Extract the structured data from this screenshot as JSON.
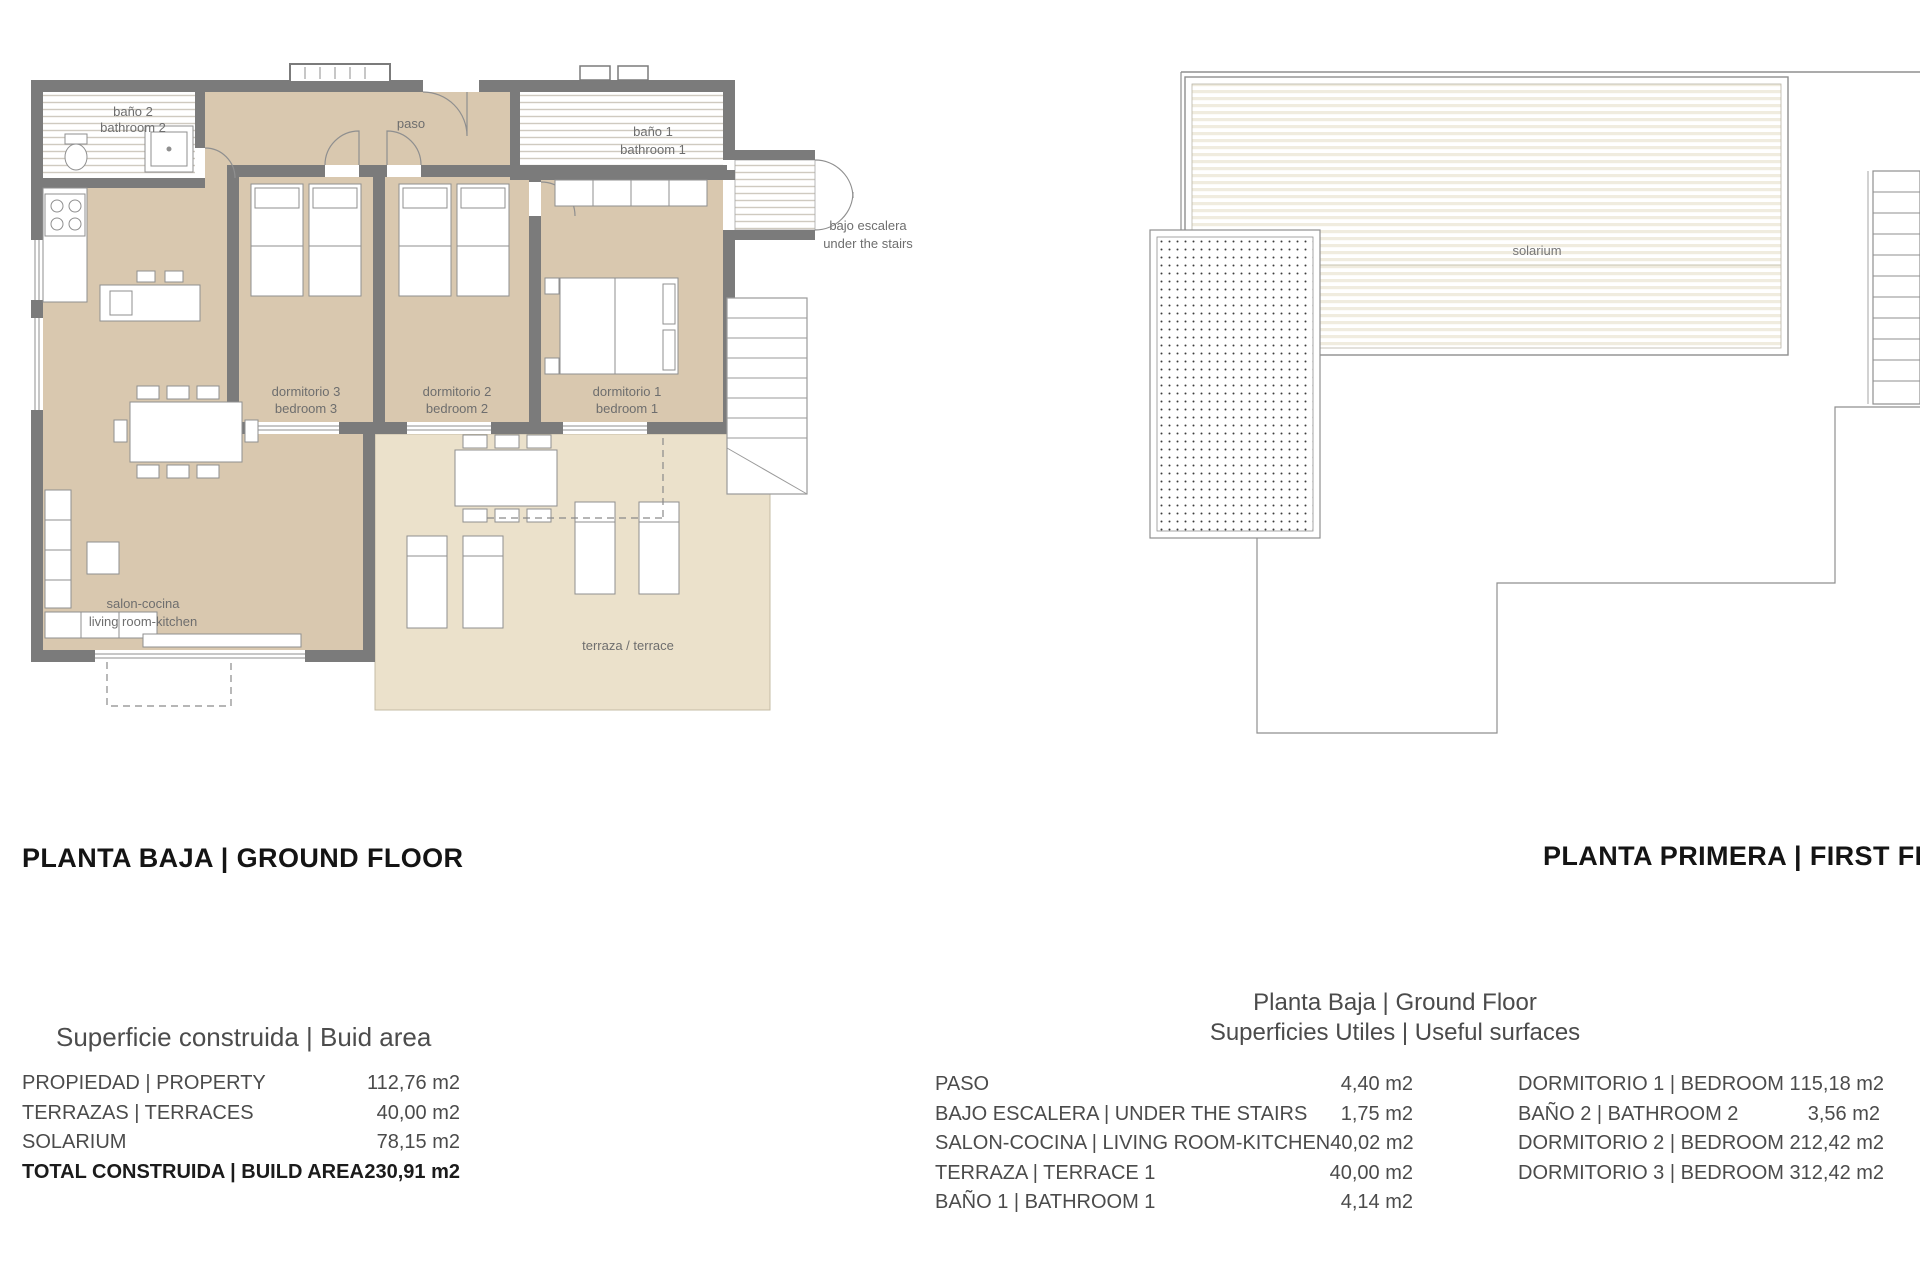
{
  "plans": {
    "ground": {
      "title": "PLANTA BAJA | GROUND FLOOR",
      "rooms": {
        "bano2_l1": "baño 2",
        "bano2_l2": "bathroom 2",
        "paso": "paso",
        "bano1_l1": "baño 1",
        "bano1_l2": "bathroom 1",
        "bajo_l1": "bajo escalera",
        "bajo_l2": "under the stairs",
        "dorm3_l1": "dormitorio 3",
        "dorm3_l2": "bedroom 3",
        "dorm2_l1": "dormitorio 2",
        "dorm2_l2": "bedroom 2",
        "dorm1_l1": "dormitorio 1",
        "dorm1_l2": "bedroom 1",
        "salon_l1": "salon-cocina",
        "salon_l2": "living room-kitchen",
        "terraza": "terraza / terrace"
      }
    },
    "first": {
      "title": "PLANTA PRIMERA | FIRST FLOOR",
      "rooms": {
        "solarium": "solarium"
      }
    }
  },
  "built_area_table": {
    "title": "Superficie construida | Buid area",
    "rows": [
      {
        "label": "PROPIEDAD | PROPERTY",
        "value": "112,76 m2"
      },
      {
        "label": "TERRAZAS | TERRACES",
        "value": "40,00 m2"
      },
      {
        "label": "SOLARIUM",
        "value": "78,15 m2"
      },
      {
        "label": "TOTAL CONSTRUIDA | BUILD AREA",
        "value": "230,91 m2"
      }
    ]
  },
  "useful_surfaces_table": {
    "title_line1": "Planta Baja | Ground Floor",
    "title_line2": "Superficies Utiles | Useful surfaces",
    "left_rows": [
      {
        "label": "PASO",
        "value": "4,40 m2"
      },
      {
        "label": "BAJO ESCALERA | UNDER THE STAIRS",
        "value": "1,75 m2"
      },
      {
        "label": "SALON-COCINA | LIVING ROOM-KITCHEN",
        "value": "40,02 m2"
      },
      {
        "label": "TERRAZA | TERRACE 1",
        "value": "40,00 m2"
      },
      {
        "label": "BAÑO 1 | BATHROOM 1",
        "value": "4,14 m2"
      }
    ],
    "right_rows": [
      {
        "label": "DORMITORIO 1 | BEDROOM 1",
        "value": "15,18 m2"
      },
      {
        "label": "BAÑO 2 | BATHROOM 2",
        "value": "3,56 m2"
      },
      {
        "label": "DORMITORIO 2 | BEDROOM 2",
        "value": "12,42 m2"
      },
      {
        "label": "DORMITORIO 3 | BEDROOM 3",
        "value": "12,42 m2"
      }
    ]
  },
  "colors": {
    "wall_gray": "#7b7b7b",
    "interior_tan": "#d9c8af",
    "terrace_tan": "#ebe1cb",
    "deck_stripe": "#f0ecdf",
    "line_gray": "#8f8f8f",
    "label_gray": "#6e6e6e"
  }
}
